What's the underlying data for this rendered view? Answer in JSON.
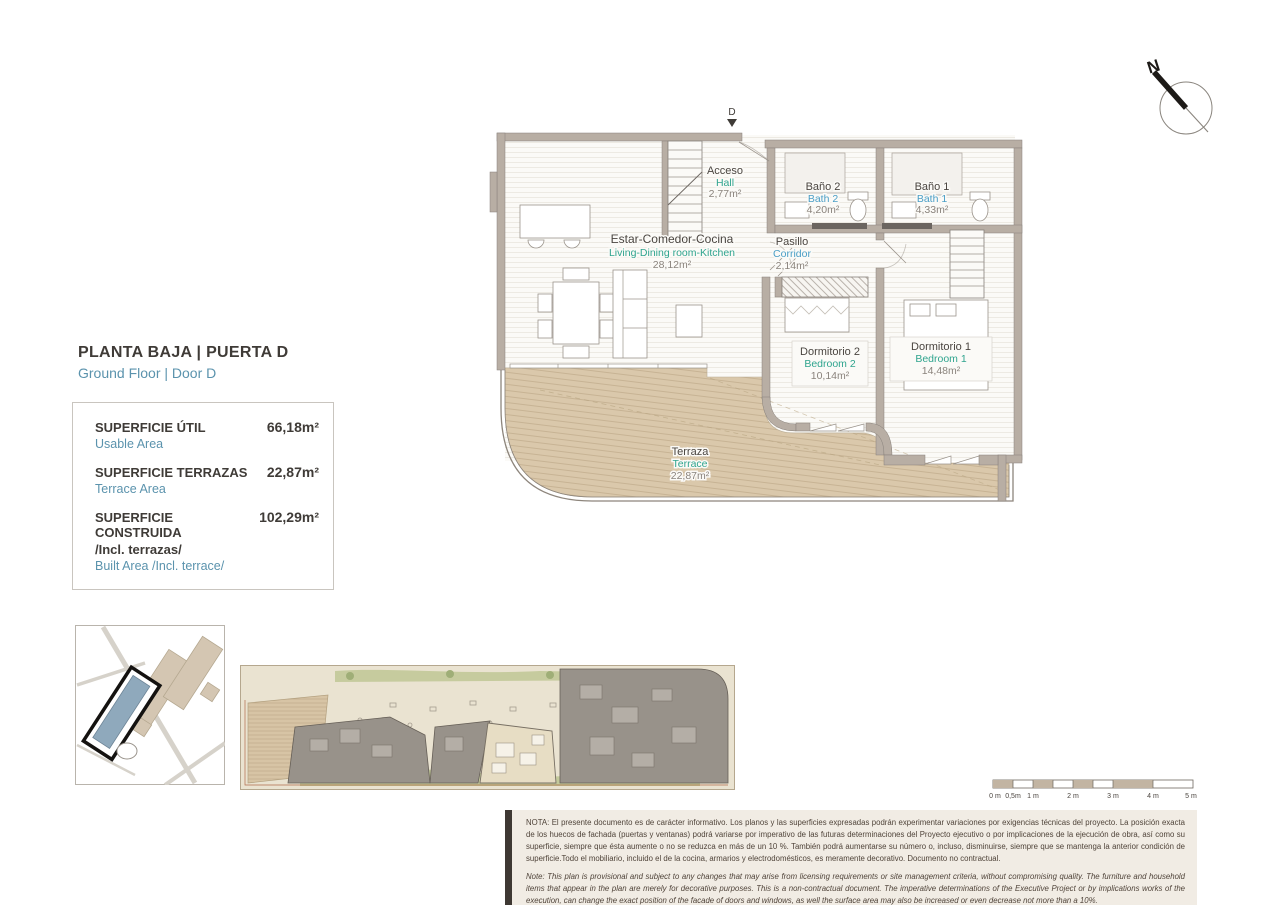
{
  "title": {
    "es": "PLANTA BAJA | PUERTA D",
    "en": "Ground Floor | Door D"
  },
  "areas_box": {
    "rows": [
      {
        "label_es": "SUPERFICIE ÚTIL",
        "label_en": "Usable Area",
        "value": "66,18m²"
      },
      {
        "label_es": "SUPERFICIE TERRAZAS",
        "label_en": "Terrace Area",
        "value": "22,87m²"
      },
      {
        "label_es": "SUPERFICIE CONSTRUIDA",
        "label_es2": "/Incl. terrazas/",
        "label_en": "Built Area /Incl. terrace/",
        "value": "102,29m²"
      }
    ]
  },
  "floor_plan": {
    "entrance_label": "D",
    "rooms": [
      {
        "name_es": "Acceso",
        "name_en": "Hall",
        "area": "2,77m²"
      },
      {
        "name_es": "Baño 2",
        "name_en": "Bath 2",
        "area": "4,20m²"
      },
      {
        "name_es": "Baño 1",
        "name_en": "Bath 1",
        "area": "4,33m²"
      },
      {
        "name_es": "Estar-Comedor-Cocina",
        "name_en": "Living-Dining room-Kitchen",
        "area": "28,12m²"
      },
      {
        "name_es": "Pasillo",
        "name_en": "Corridor",
        "area": "2,14m²"
      },
      {
        "name_es": "Dormitorio 2",
        "name_en": "Bedroom 2",
        "area": "10,14m²"
      },
      {
        "name_es": "Dormitorio 1",
        "name_en": "Bedroom 1",
        "area": "14,48m²"
      },
      {
        "name_es": "Terraza",
        "name_en": "Terrace",
        "area": "22,87m²"
      }
    ]
  },
  "north_label": "N",
  "scale_bar": {
    "labels": [
      "0 m",
      "0,5m",
      "1 m",
      "2 m",
      "3 m",
      "4 m",
      "5 m"
    ]
  },
  "disclaimer": {
    "es": "NOTA: El presente documento es de carácter informativo. Los planos y las superficies expresadas podrán experimentar variaciones por exigencias técnicas del proyecto. La posición exacta de los huecos de fachada (puertas y ventanas) podrá variarse por imperativo de las futuras determinaciones del Proyecto ejecutivo o por implicaciones de la ejecución de obra, así como su superficie, siempre que ésta aumente o no se reduzca en más de un 10 %. También podrá aumentarse su número o, incluso, disminuirse, siempre que se mantenga la anterior condición de superficie.Todo el mobiliario, incluido el de la cocina, armarios y electrodomésticos, es meramente decorativo. Documento no contractual.",
    "en": "Note: This plan is provisional and subject to any changes that may arise from licensing requirements or site management criteria, without compromising quality. The furniture and household items that appear in the plan are merely for decorative purposes. This is a non-contractual document. The imperative determinations of the Executive Project or by implications works of the execution, can change the exact position of the facade of doors and windows, as well the surface area may also be increased or even decrease not more than a 10%.",
    "version": "V.1_JUN-25"
  },
  "colors": {
    "accent_teal": "#2fa48e",
    "accent_blue": "#4a9ec6",
    "title_dark": "#3f3b37",
    "wall": "#b8aea4",
    "terrace_deck": "#dac8ab",
    "highlight_unit_fill": "#8fa9bc",
    "highlight_outline": "#141210",
    "site_building_gray": "#98928a",
    "disclaimer_bg": "#f1ece4"
  }
}
